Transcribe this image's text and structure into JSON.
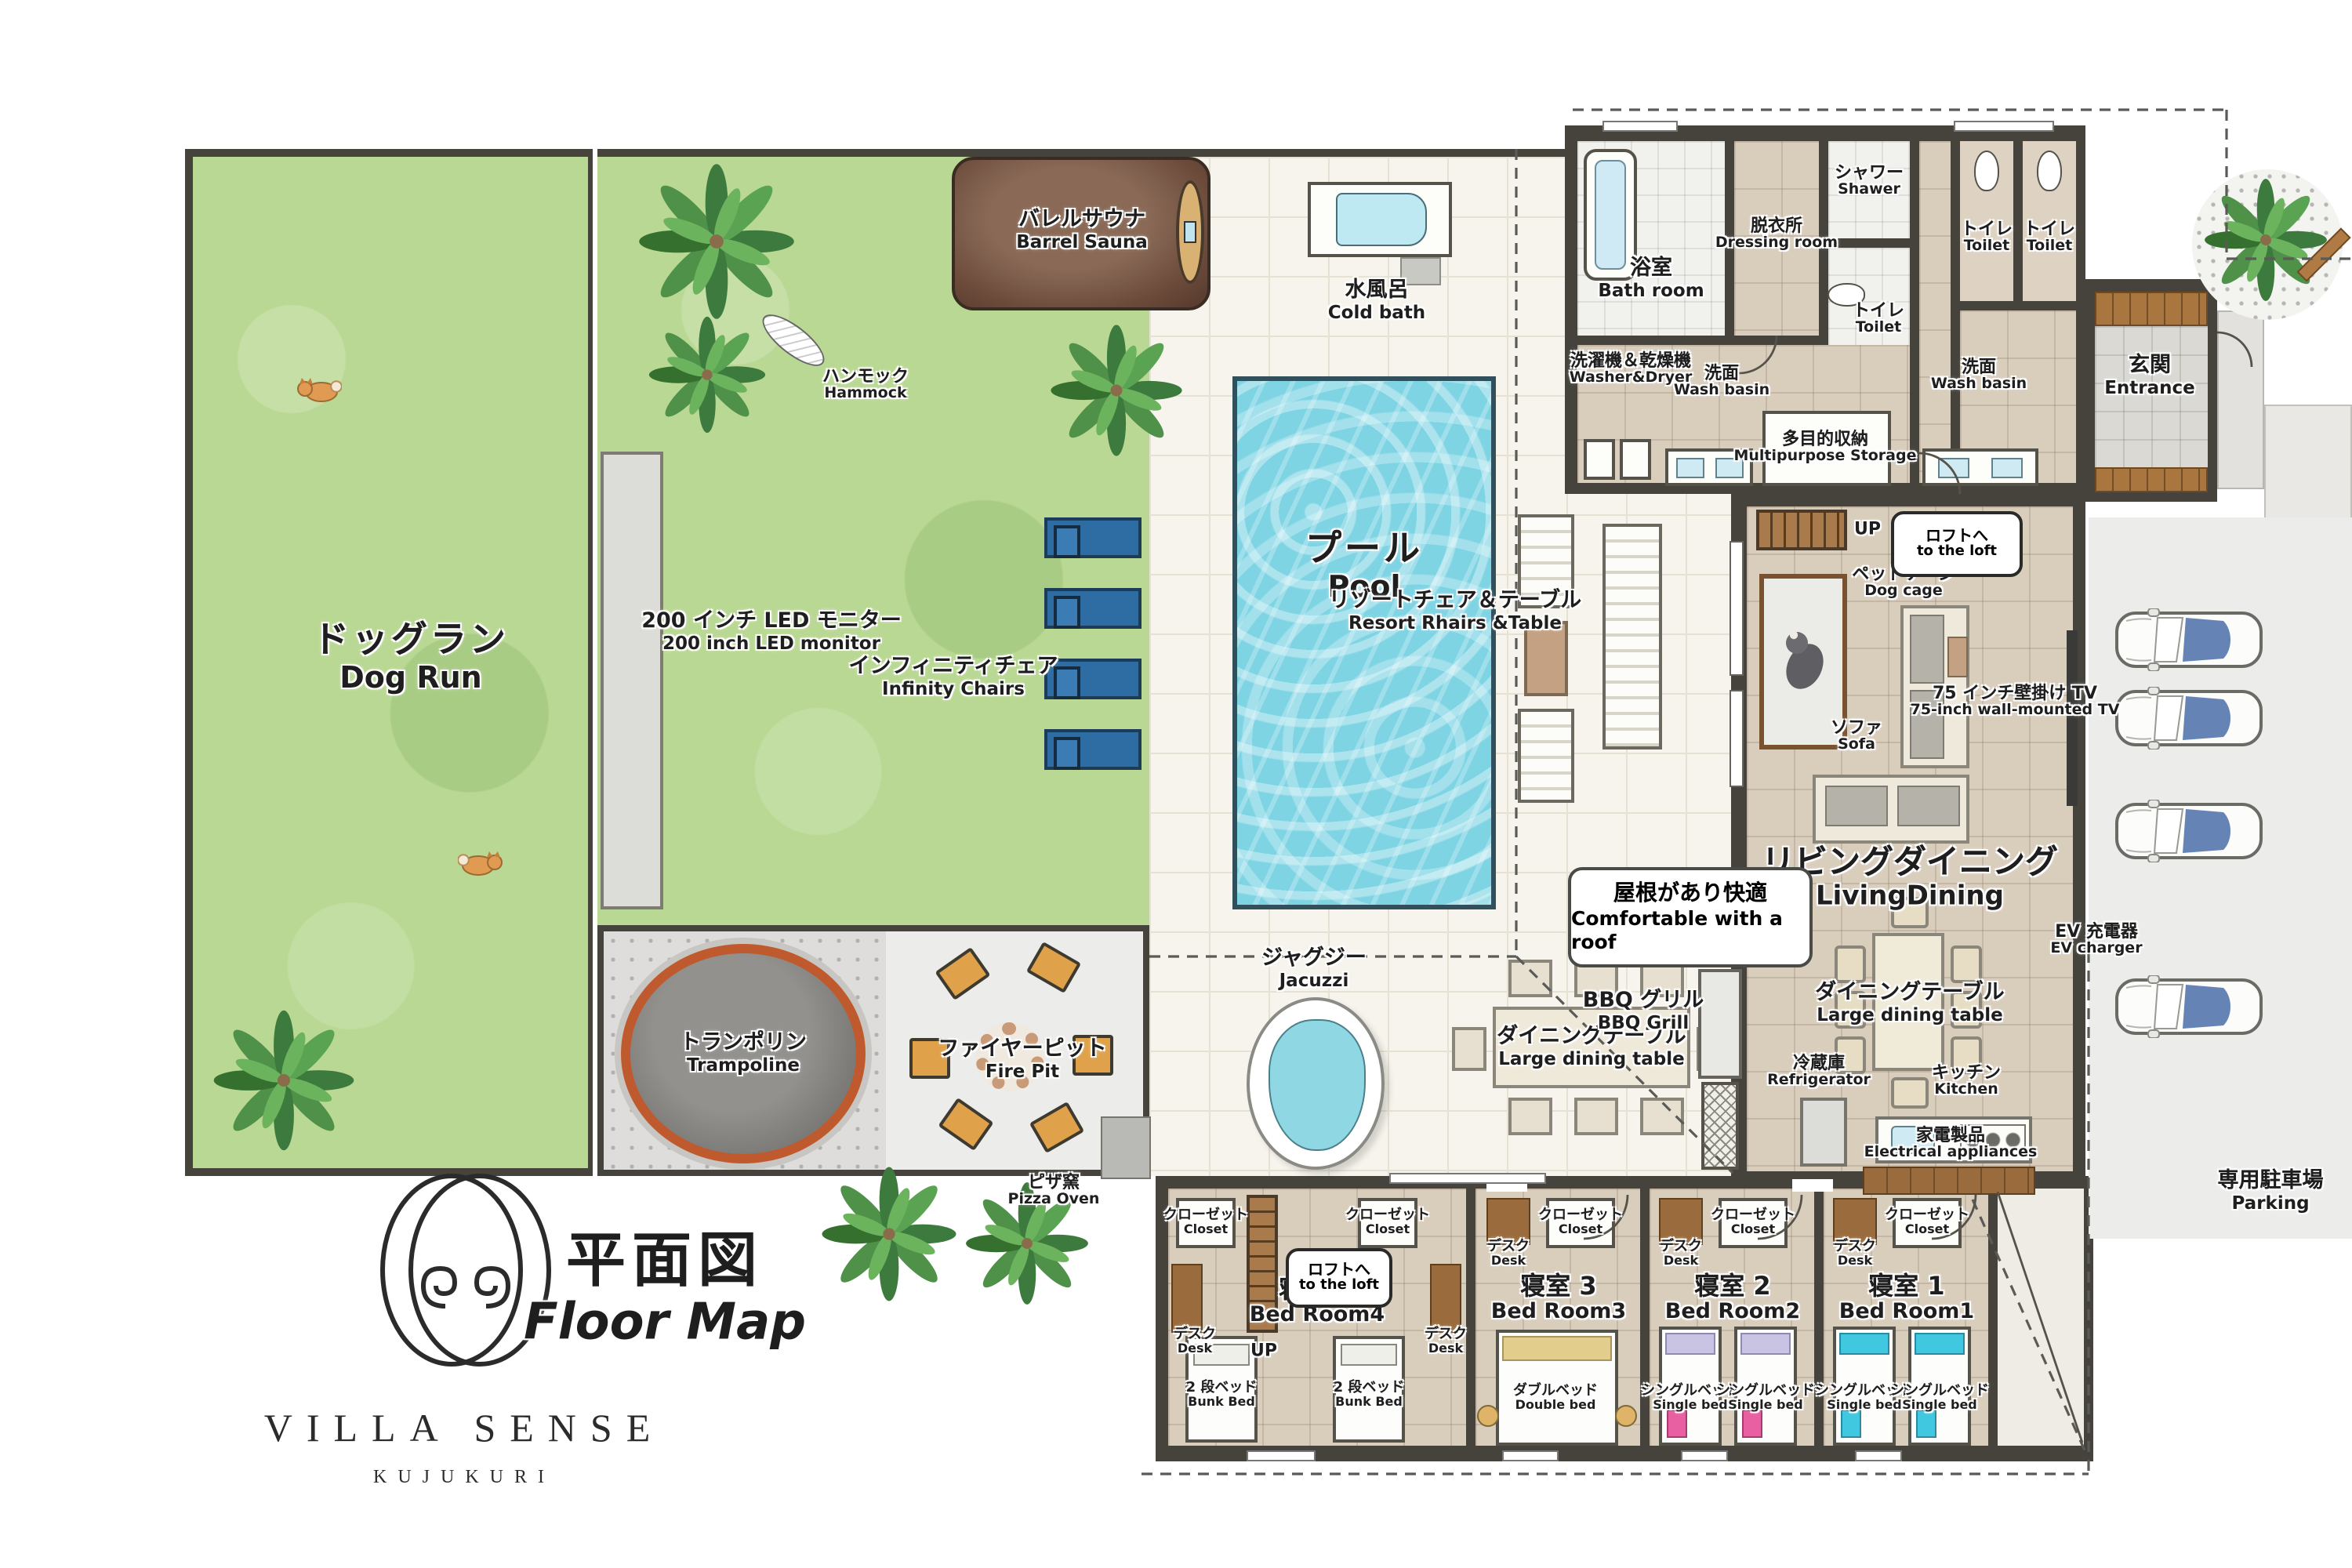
{
  "logo": {
    "brand": "VILLA SENSE",
    "sub": "KUJUKURI"
  },
  "title": {
    "jp": "平面図",
    "en": "Floor Map"
  },
  "outdoor": {
    "dog_run": {
      "jp": "ドッグラン",
      "en": "Dog Run"
    },
    "monitor": {
      "jp": "200 インチ LED モニター",
      "en": "200 inch LED monitor"
    },
    "infinity_chairs": {
      "jp": "インフィニティチェア",
      "en": "Infinity Chairs"
    },
    "hammock": {
      "jp": "ハンモック",
      "en": "Hammock"
    },
    "barrel_sauna": {
      "jp": "バレルサウナ",
      "en": "Barrel Sauna"
    },
    "cold_bath": {
      "jp": "水風呂",
      "en": "Cold bath"
    },
    "pool": {
      "jp": "プール",
      "en": "Pool"
    },
    "jacuzzi": {
      "jp": "ジャグジー",
      "en": "Jacuzzi"
    },
    "trampoline": {
      "jp": "トランポリン",
      "en": "Trampoline"
    },
    "fire_pit": {
      "jp": "ファイヤーピット",
      "en": "Fire Pit"
    },
    "pizza_oven": {
      "jp": "ピザ窯",
      "en": "Pizza Oven"
    },
    "outdoor_dining": {
      "jp": "ダイニングテーブル",
      "en": "Large dining table"
    },
    "bbq": {
      "jp": "BBQ グリル",
      "en": "BBQ Grill"
    },
    "roof_note": {
      "jp": "屋根があり快適",
      "en": "Comfortable with a roof"
    },
    "resort_set": {
      "jp": "リゾートチェア＆テーブル",
      "en": "Resort Rhairs &Table"
    },
    "parking": {
      "jp": "専用駐車場",
      "en": "Parking"
    },
    "ev_charger": {
      "jp": "EV 充電器",
      "en": "EV charger"
    }
  },
  "house": {
    "bath": {
      "jp": "浴室",
      "en": "Bath room"
    },
    "dressing": {
      "jp": "脱衣所",
      "en": "Dressing room"
    },
    "shower": {
      "jp": "シャワー",
      "en": "Shawer"
    },
    "toilet": {
      "jp": "トイレ",
      "en": "Toilet"
    },
    "washer": {
      "jp": "洗濯機＆乾燥機",
      "en": "Washer&Dryer"
    },
    "wash_basin": {
      "jp": "洗面",
      "en": "Wash basin"
    },
    "storage": {
      "jp": "多目的収納",
      "en": "Multipurpose Storage"
    },
    "entrance": {
      "jp": "玄関",
      "en": "Entrance"
    },
    "dog_cage": {
      "jp": "ペットケージ",
      "en": "Dog cage"
    },
    "sofa": {
      "jp": "ソファ",
      "en": "Sofa"
    },
    "tv": {
      "jp": "75 インチ壁掛け TV",
      "en": "75-inch wall-mounted TV"
    },
    "living": {
      "jp": "リビングダイニング",
      "en": "LivingDining"
    },
    "dining": {
      "jp": "ダイニングテーブル",
      "en": "Large dining table"
    },
    "kitchen": {
      "jp": "キッチン",
      "en": "Kitchen"
    },
    "fridge": {
      "jp": "冷蔵庫",
      "en": "Refrigerator"
    },
    "appliances": {
      "jp": "家電製品",
      "en": "Electrical appliances"
    },
    "up": "UP",
    "loft": {
      "jp": "ロフトへ",
      "en": "to the loft"
    }
  },
  "bedrooms": {
    "closet": {
      "jp": "クローゼット",
      "en": "Closet"
    },
    "desk": {
      "jp": "デスク",
      "en": "Desk"
    },
    "room4": {
      "jp": "寝室 4",
      "en": "Bed Room4"
    },
    "room3": {
      "jp": "寝室 3",
      "en": "Bed Room3"
    },
    "room2": {
      "jp": "寝室 2",
      "en": "Bed Room2"
    },
    "room1": {
      "jp": "寝室 1",
      "en": "Bed Room1"
    },
    "bunk_bed": {
      "jp": "2 段ベッド",
      "en": "Bunk Bed"
    },
    "double_bed": {
      "jp": "ダブルベッド",
      "en": "Double bed"
    },
    "single_bed": {
      "jp": "シングルベッド",
      "en": "Single bed"
    }
  },
  "colors": {
    "lawn": "#b9d893",
    "pool_water": "#7fd4e4",
    "wall": "#45433c",
    "trampoline_ring": "#bf5a2e",
    "infinity_chair": "#2e6da3",
    "wood": "#a97a4c",
    "accent_pink": "#e85fa2",
    "accent_cyan": "#3fc8e0",
    "accent_lavender": "#c9c4e4"
  }
}
